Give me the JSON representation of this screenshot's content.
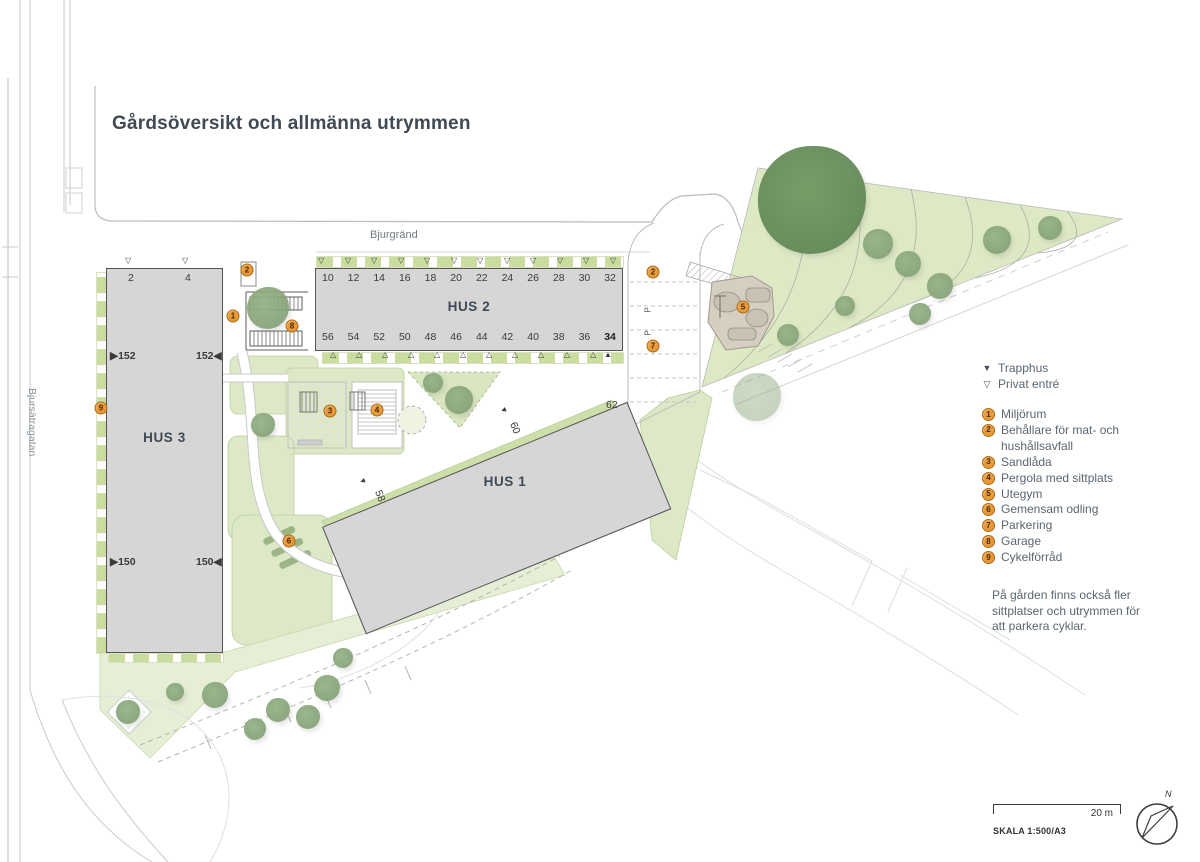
{
  "title": "Gårdsöversikt och allmänna utrymmen",
  "streets": {
    "top_label": "Bjurgränd",
    "left_label": "Bjursätragatan"
  },
  "buildings": {
    "hus1": {
      "label": "HUS 1",
      "numbers": [
        {
          "value": "58",
          "x": 374,
          "y": 490,
          "rot": 68
        },
        {
          "value": "60",
          "x": 509,
          "y": 422,
          "rot": 68
        },
        {
          "value": "62",
          "x": 606,
          "y": 399
        }
      ]
    },
    "hus2": {
      "label": "HUS 2",
      "top_numbers": [
        "10",
        "12",
        "14",
        "16",
        "18",
        "20",
        "22",
        "24",
        "26",
        "28",
        "30",
        "32"
      ],
      "bottom_numbers": [
        "56",
        "54",
        "52",
        "50",
        "48",
        "46",
        "44",
        "42",
        "40",
        "38",
        "36",
        "34"
      ]
    },
    "hus3": {
      "label": "HUS 3",
      "top_numbers": [
        {
          "value": "2",
          "x": 128,
          "y": 272
        },
        {
          "value": "4",
          "x": 185,
          "y": 272
        }
      ],
      "side_numbers": [
        {
          "value": "▶152",
          "x": 110,
          "y": 350
        },
        {
          "value": "152◀",
          "x": 196,
          "y": 350
        },
        {
          "value": "▶150",
          "x": 110,
          "y": 556
        },
        {
          "value": "150◀",
          "x": 196,
          "y": 556
        }
      ]
    }
  },
  "legend": {
    "entries": [
      {
        "icon": "▼",
        "label": "Trapphus"
      },
      {
        "icon": "▽",
        "label": "Privat entré"
      }
    ],
    "items": [
      {
        "num": "1",
        "label": "Miljörum"
      },
      {
        "num": "2",
        "label": "Behållare för mat- och hushållsavfall"
      },
      {
        "num": "3",
        "label": "Sandlåda"
      },
      {
        "num": "4",
        "label": "Pergola med sittplats"
      },
      {
        "num": "5",
        "label": "Utegym"
      },
      {
        "num": "6",
        "label": "Gemensam odling"
      },
      {
        "num": "7",
        "label": "Parkering"
      },
      {
        "num": "8",
        "label": "Garage"
      },
      {
        "num": "9",
        "label": "Cykelförråd"
      }
    ],
    "note": "På gården finns också fler sittplatser och utrymmen för att parkera cyklar."
  },
  "map_markers": [
    {
      "num": "1",
      "x": 233,
      "y": 316
    },
    {
      "num": "2",
      "x": 247,
      "y": 270
    },
    {
      "num": "2",
      "x": 653,
      "y": 272
    },
    {
      "num": "3",
      "x": 330,
      "y": 411
    },
    {
      "num": "4",
      "x": 377,
      "y": 410
    },
    {
      "num": "5",
      "x": 743,
      "y": 307
    },
    {
      "num": "6",
      "x": 289,
      "y": 541
    },
    {
      "num": "7",
      "x": 653,
      "y": 346
    },
    {
      "num": "8",
      "x": 292,
      "y": 326
    },
    {
      "num": "9",
      "x": 101,
      "y": 408
    }
  ],
  "entry_triangles": [
    {
      "icon": "▽",
      "x": 322,
      "y": 261
    },
    {
      "icon": "▽",
      "x": 349,
      "y": 261
    },
    {
      "icon": "▽",
      "x": 375,
      "y": 261
    },
    {
      "icon": "▽",
      "x": 402,
      "y": 261
    },
    {
      "icon": "▽",
      "x": 428,
      "y": 261
    },
    {
      "icon": "▽",
      "x": 455,
      "y": 261
    },
    {
      "icon": "▽",
      "x": 481,
      "y": 261
    },
    {
      "icon": "▽",
      "x": 508,
      "y": 261
    },
    {
      "icon": "▽",
      "x": 534,
      "y": 261
    },
    {
      "icon": "▽",
      "x": 561,
      "y": 261
    },
    {
      "icon": "▽",
      "x": 587,
      "y": 261
    },
    {
      "icon": "▽",
      "x": 614,
      "y": 261
    },
    {
      "icon": "△",
      "x": 334,
      "y": 355
    },
    {
      "icon": "△",
      "x": 360,
      "y": 355
    },
    {
      "icon": "△",
      "x": 386,
      "y": 355
    },
    {
      "icon": "△",
      "x": 412,
      "y": 355
    },
    {
      "icon": "△",
      "x": 438,
      "y": 355
    },
    {
      "icon": "△",
      "x": 464,
      "y": 355
    },
    {
      "icon": "△",
      "x": 490,
      "y": 355
    },
    {
      "icon": "△",
      "x": 516,
      "y": 355
    },
    {
      "icon": "△",
      "x": 542,
      "y": 355
    },
    {
      "icon": "△",
      "x": 568,
      "y": 355
    },
    {
      "icon": "△",
      "x": 594,
      "y": 355
    },
    {
      "icon": "▲",
      "x": 608,
      "y": 355
    },
    {
      "icon": "▽",
      "x": 129,
      "y": 261
    },
    {
      "icon": "▽",
      "x": 186,
      "y": 261
    },
    {
      "icon": "▲",
      "x": 363,
      "y": 481,
      "rot": -112
    },
    {
      "icon": "▲",
      "x": 504,
      "y": 410,
      "rot": -112
    }
  ],
  "parking_symbols": [
    {
      "label": "P",
      "x": 646,
      "y": 306,
      "rot": -90
    },
    {
      "label": "P",
      "x": 646,
      "y": 329,
      "rot": -90
    }
  ],
  "trees": [
    {
      "x": 812,
      "y": 200,
      "r": 54,
      "cls": "dark"
    },
    {
      "x": 757,
      "y": 397,
      "r": 24,
      "cls": "pale"
    },
    {
      "x": 878,
      "y": 244,
      "r": 15
    },
    {
      "x": 908,
      "y": 264,
      "r": 13
    },
    {
      "x": 940,
      "y": 286,
      "r": 13
    },
    {
      "x": 997,
      "y": 240,
      "r": 14
    },
    {
      "x": 1050,
      "y": 228,
      "r": 12
    },
    {
      "x": 920,
      "y": 314,
      "r": 11
    },
    {
      "x": 845,
      "y": 306,
      "r": 10
    },
    {
      "x": 788,
      "y": 335,
      "r": 11
    },
    {
      "x": 268,
      "y": 308,
      "r": 21
    },
    {
      "x": 263,
      "y": 425,
      "r": 12
    },
    {
      "x": 459,
      "y": 400,
      "r": 14
    },
    {
      "x": 433,
      "y": 383,
      "r": 10
    },
    {
      "x": 128,
      "y": 712,
      "r": 12
    },
    {
      "x": 175,
      "y": 692,
      "r": 9
    },
    {
      "x": 215,
      "y": 695,
      "r": 13
    },
    {
      "x": 278,
      "y": 710,
      "r": 12
    },
    {
      "x": 308,
      "y": 717,
      "r": 12
    },
    {
      "x": 327,
      "y": 688,
      "r": 13
    },
    {
      "x": 343,
      "y": 658,
      "r": 10
    },
    {
      "x": 255,
      "y": 729,
      "r": 11
    }
  ],
  "scalebar": {
    "distance": "20 m",
    "scale": "SKALA 1:500/A3"
  },
  "north_label": "N",
  "colors": {
    "accent_orange": "#E8993A",
    "building_fill": "#D6D6D6",
    "park_green": "#DDE9C4",
    "title_color": "#3F4A54"
  }
}
